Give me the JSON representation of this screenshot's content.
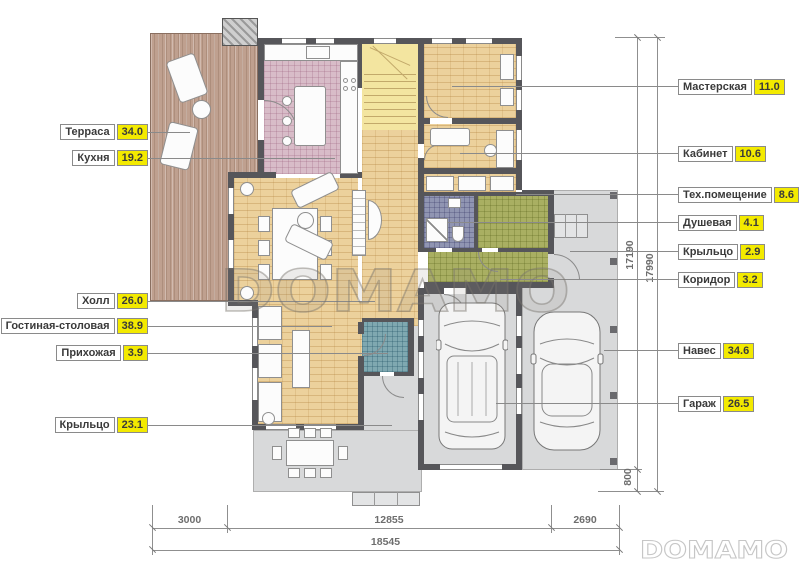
{
  "watermark": {
    "center": "DOMAMO",
    "corner": "DOMAMO"
  },
  "labels_left": [
    {
      "name": "Терраса",
      "value": "34.0"
    },
    {
      "name": "Кухня",
      "value": "19.2"
    },
    {
      "name": "Холл",
      "value": "26.0"
    },
    {
      "name": "Гостиная-столовая",
      "value": "38.9"
    },
    {
      "name": "Прихожая",
      "value": "3.9"
    },
    {
      "name": "Крыльцо",
      "value": "23.1"
    }
  ],
  "labels_right": [
    {
      "name": "Мастерская",
      "value": "11.0"
    },
    {
      "name": "Кабинет",
      "value": "10.6"
    },
    {
      "name": "Тех.помещение",
      "value": "8.6"
    },
    {
      "name": "Душевая",
      "value": "4.1"
    },
    {
      "name": "Крыльцо",
      "value": "2.9"
    },
    {
      "name": "Коридор",
      "value": "3.2"
    },
    {
      "name": "Навес",
      "value": "34.6"
    },
    {
      "name": "Гараж",
      "value": "26.5"
    }
  ],
  "dimensions": {
    "bottom_segments": [
      "3000",
      "12855",
      "2690"
    ],
    "bottom_total": "18545",
    "vertical_inner": "17190",
    "vertical_outer": "17990",
    "vertical_porch": "800"
  },
  "colors": {
    "accent_value_bg": "#f3ea00",
    "wall": "#56565a",
    "wood_floor": "#ecd19c",
    "kitchen_tile": "#d8bcc8",
    "wet_room_tile": "#9095b2",
    "utility_tile": "#a9af62",
    "entry_tile": "#7fa8b0",
    "terrace_deck": "#bfa08f",
    "stairs": "#f3e5a0",
    "paving": "#d8d9da"
  }
}
